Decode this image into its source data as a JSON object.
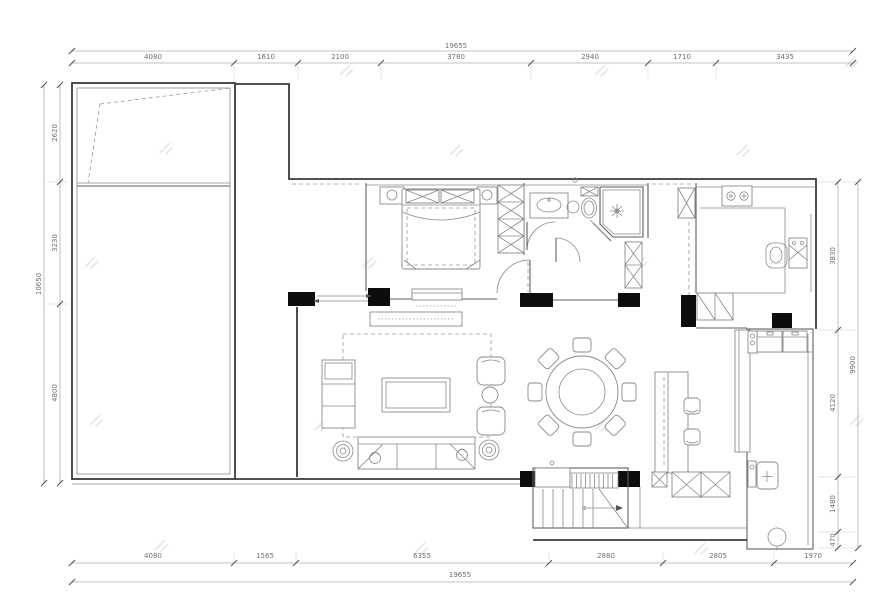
{
  "drawing": {
    "type": "residential floor plan (CAD, top view)",
    "dimensions": {
      "top_total": "19655",
      "top_segments": [
        "4080",
        "1610",
        "2100",
        "3780",
        "2940",
        "1710",
        "3435"
      ],
      "bottom_segments": [
        "4080",
        "1565",
        "6355",
        "2880",
        "2805",
        "1970"
      ],
      "bottom_total": "19655",
      "left_total": "10650",
      "left_segments": [
        "2620",
        "3230",
        "4800"
      ],
      "right_total": "9900",
      "right_segments": [
        "3830",
        "4120",
        "1480",
        "470"
      ]
    },
    "colors": {
      "background": "#ffffff",
      "wall": "#3a3a3a",
      "wall-light": "#5f5f5f",
      "furniture": "#8a8a8a",
      "dashed": "#9a9a9a",
      "dim-line": "#b0b0b0",
      "dim-text": "#6f6f6f",
      "column-fill": "#0d0d0d",
      "watermark": "#e4e4e4"
    }
  }
}
